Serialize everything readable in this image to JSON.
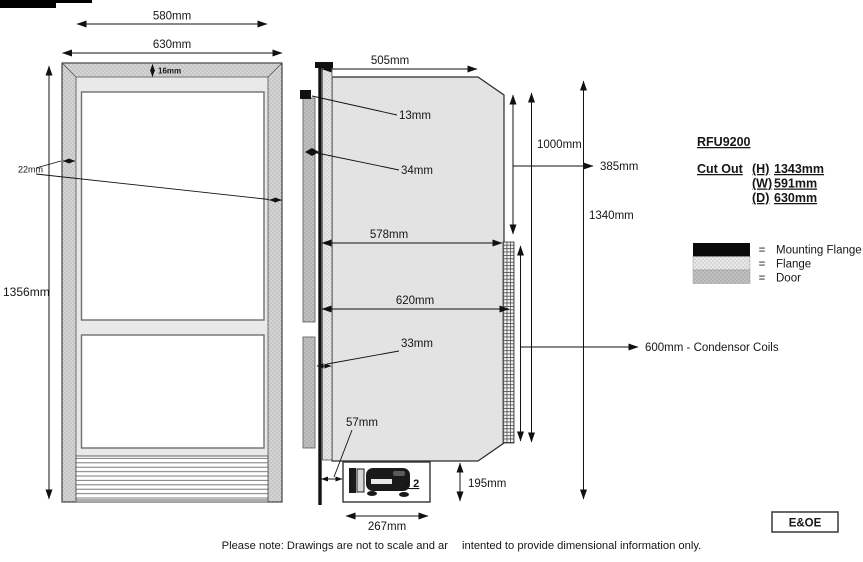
{
  "title": "RFU9200 dimensional drawing",
  "door_front": {
    "width_inner": "580mm",
    "width_outer": "630mm",
    "frame_top": "16mm",
    "frame_side": "22mm",
    "height": "1356mm"
  },
  "side_view": {
    "depth_top": "505mm",
    "mounting_flange_depth": "13mm",
    "door_thickness": "34mm",
    "depth_to_coils": "578mm",
    "depth_overall": "620mm",
    "flange_width": "33mm",
    "flange_offset": "57mm",
    "compressor_width": "267mm",
    "compressor_height": "195mm",
    "coil_top_offset": "385mm",
    "height_upper": "1000mm",
    "height_overall": "1340mm",
    "condenser_label": "600mm - Condensor Coils",
    "compressor_qty": "x 2"
  },
  "info": {
    "model": "RFU9200",
    "cutout_label": "Cut Out",
    "cutout": [
      {
        "key": "(H)",
        "value": "1343mm"
      },
      {
        "key": "(W)",
        "value": "591mm"
      },
      {
        "key": "(D)",
        "value": "630mm"
      }
    ],
    "legend": [
      {
        "symbol": "=",
        "label": "Mounting Flange"
      },
      {
        "symbol": "=",
        "label": "Flange"
      },
      {
        "symbol": "=",
        "label": "Door"
      }
    ]
  },
  "footer": {
    "note_part1": "Please note: Drawings are not to scale and ar",
    "note_part2": "intented to provide dimensional information only.",
    "eoe": "E&OE"
  },
  "colors": {
    "body_gray": "#e3e3e3",
    "flange_stipple": "#e7e7e7",
    "door_stipple": "#c0c0c0",
    "line": "#111111",
    "background": "#ffffff"
  }
}
